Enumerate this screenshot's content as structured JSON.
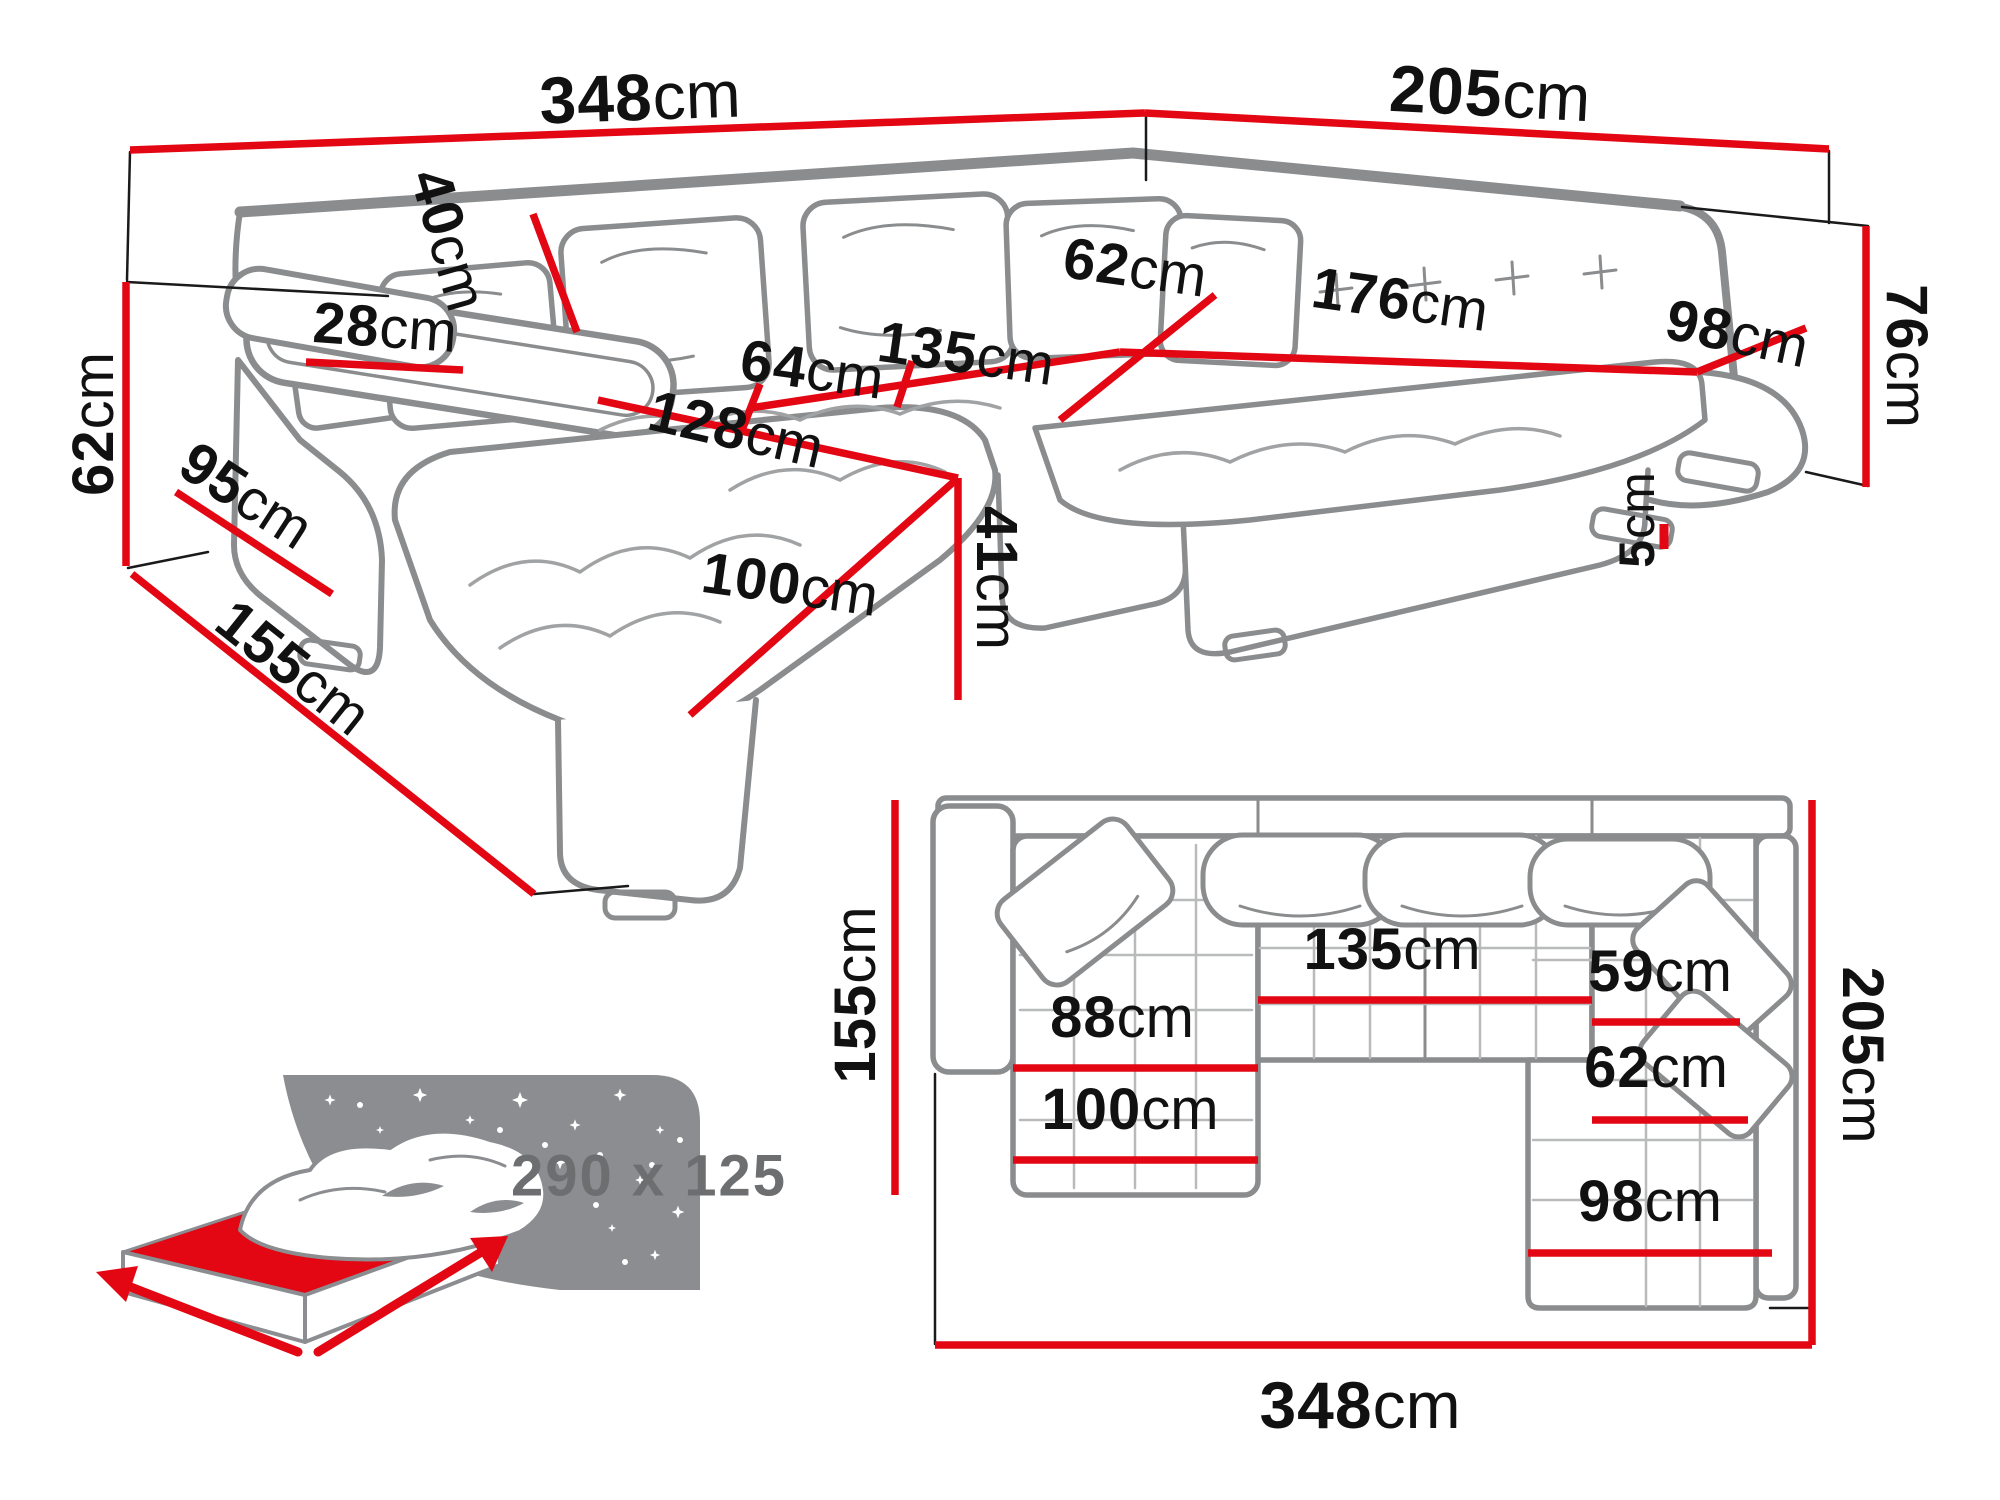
{
  "colors": {
    "accent_red": "#e30613",
    "sofa_outline_gray": "#8a8c8e",
    "label_black": "#111111",
    "bed_text_gray": "#6d6e70"
  },
  "perspective_view": {
    "d348": {
      "v": "348",
      "u": "cm"
    },
    "d205": {
      "v": "205",
      "u": "cm"
    },
    "d76": {
      "v": "76",
      "u": "cm"
    },
    "d62_left": {
      "v": "62",
      "u": "cm"
    },
    "d155": {
      "v": "155",
      "u": "cm"
    },
    "d95": {
      "v": "95",
      "u": "cm"
    },
    "d28": {
      "v": "28",
      "u": "cm"
    },
    "d40": {
      "v": "40",
      "u": "cm"
    },
    "d64": {
      "v": "64",
      "u": "cm"
    },
    "d135": {
      "v": "135",
      "u": "cm"
    },
    "d128": {
      "v": "128",
      "u": "cm"
    },
    "d100": {
      "v": "100",
      "u": "cm"
    },
    "d41": {
      "v": "41",
      "u": "cm"
    },
    "d62_corner": {
      "v": "62",
      "u": "cm"
    },
    "d176": {
      "v": "176",
      "u": "cm"
    },
    "d98": {
      "v": "98",
      "u": "cm"
    },
    "d5": {
      "v": "5",
      "u": "cm"
    }
  },
  "plan_view": {
    "d155": {
      "v": "155",
      "u": "cm"
    },
    "d205": {
      "v": "205",
      "u": "cm"
    },
    "d348": {
      "v": "348",
      "u": "cm"
    },
    "d88": {
      "v": "88",
      "u": "cm"
    },
    "d135": {
      "v": "135",
      "u": "cm"
    },
    "d59": {
      "v": "59",
      "u": "cm"
    },
    "d62": {
      "v": "62",
      "u": "cm"
    },
    "d100": {
      "v": "100",
      "u": "cm"
    },
    "d98": {
      "v": "98",
      "u": "cm"
    }
  },
  "sleeping_area": {
    "label": "290 x 125"
  }
}
